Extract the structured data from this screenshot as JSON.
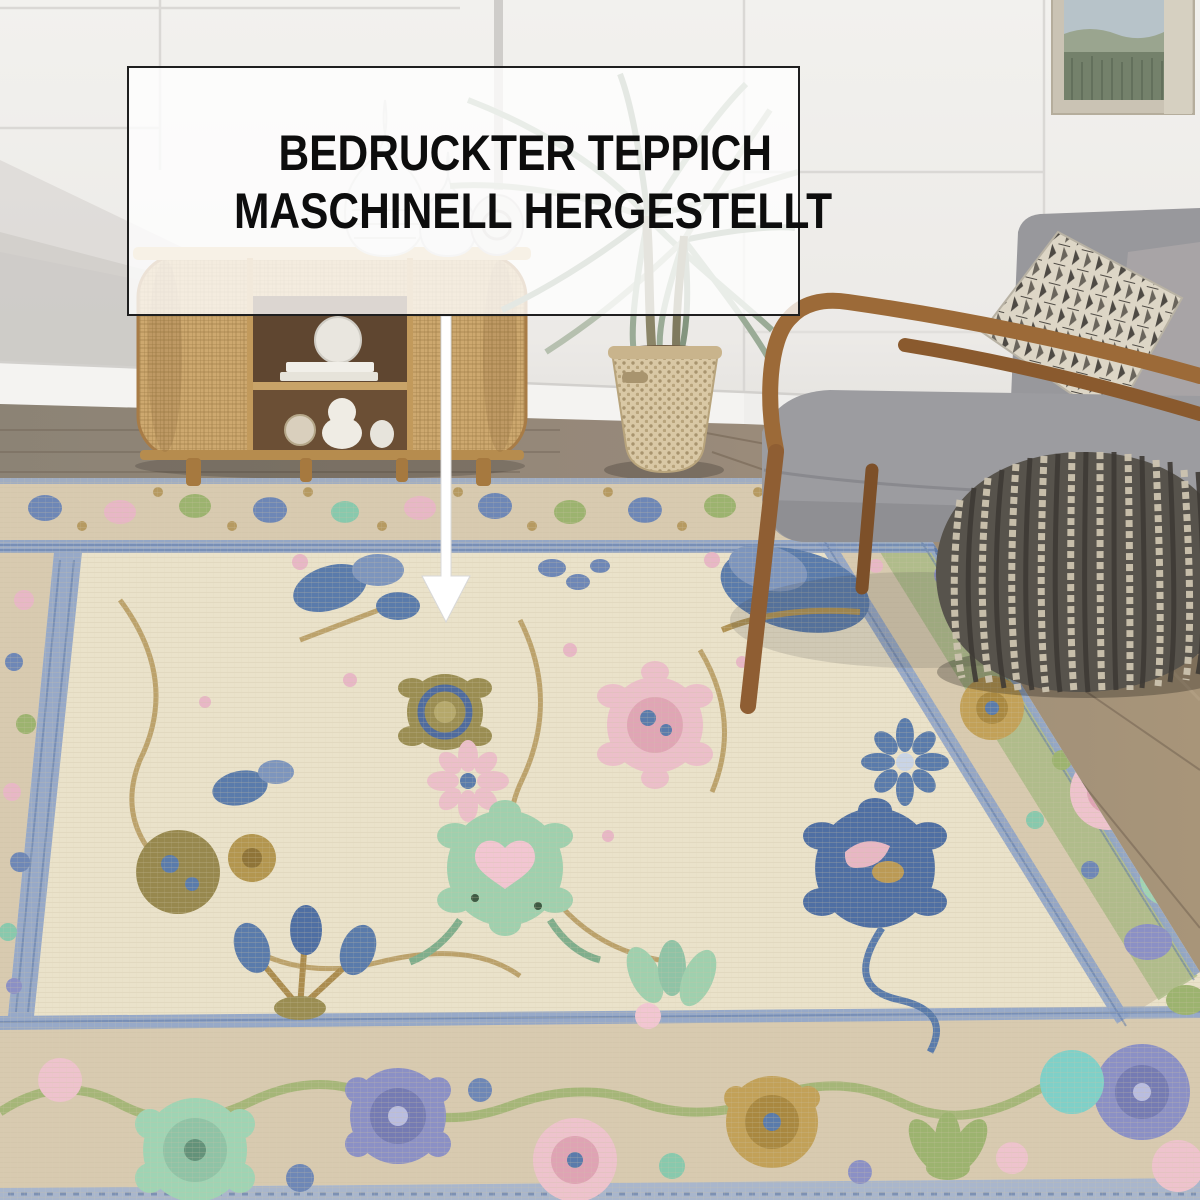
{
  "callout": {
    "line1": "BEDRUCKTER TEPPICH",
    "line2": "MASCHINELL HERGESTELLT",
    "arrow_icon": "down-arrow"
  },
  "palette": {
    "wall": "#f0efec",
    "wall-shadow": "#c7c4c0",
    "overlay-bg": "rgba(255,255,255,0.78)",
    "overlay-border": "#1f1f1f",
    "overlay-text": "#0d0d0d",
    "floor-left": "#8c8375",
    "floor-right": "#a29179",
    "rug-field": "#eae2ca",
    "rug-border-tan": "#d8cab0",
    "rug-guard-blue": "#8ea3c8",
    "motif-blue": "#5a7bab",
    "motif-steel": "#7d95bd",
    "motif-green": "#9cb36f",
    "motif-mint": "#9fd4b4",
    "motif-pink": "#eec3cd",
    "motif-teal": "#7fd0c8",
    "motif-gold": "#bb9a55",
    "motif-olive": "#9a8d52",
    "motif-purple": "#8b90c5",
    "chair-fabric": "#9a9a9e",
    "chair-wood": "#8f5e33",
    "pouf-dark": "#57534c",
    "pouf-cream": "#cdc4b0",
    "cane": "#cda86f",
    "basket": "#d9c8a5",
    "plant-green": "#9aab96"
  }
}
